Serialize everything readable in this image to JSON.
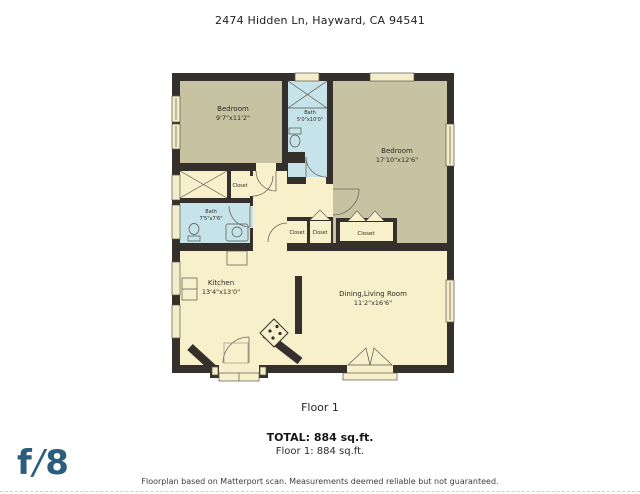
{
  "header": {
    "address": "2474 Hidden Ln, Hayward, CA 94541"
  },
  "floorplan": {
    "rooms": {
      "bedroom1": {
        "name": "Bedroom",
        "dims": "9'7\"x11'2\""
      },
      "bath1": {
        "name": "Bath",
        "dims": "5'0\"x10'0\""
      },
      "bedroom2": {
        "name": "Bedroom",
        "dims": "17'10\"x12'6\""
      },
      "bath2": {
        "name": "Bath",
        "dims": "7'5\"x7'6\""
      },
      "kitchen": {
        "name": "Kitchen",
        "dims": "13'4\"x13'0\""
      },
      "living": {
        "name": "Dining,Living Room",
        "dims": "11'2\"x16'6\""
      }
    },
    "closets": {
      "hall": "Closet",
      "row1": "Closet",
      "row2": "Closet",
      "bedroom": "Closet"
    },
    "colors": {
      "wall": "#35302b",
      "bedroom_fill": "#c7c3a2",
      "bath_fill": "#c7e3ea",
      "living_fill": "#f8f0cb"
    }
  },
  "footer": {
    "floor_label": "Floor 1",
    "total": "TOTAL: 884 sq.ft.",
    "floor_total": "Floor 1: 884 sq.ft.",
    "disclaimer": "Floorplan based on Matterport scan. Measurements deemed reliable but not guaranteed.",
    "logo": {
      "f": "f",
      "slash": "/",
      "eight": "8",
      "color": "#2b5e7d"
    }
  }
}
